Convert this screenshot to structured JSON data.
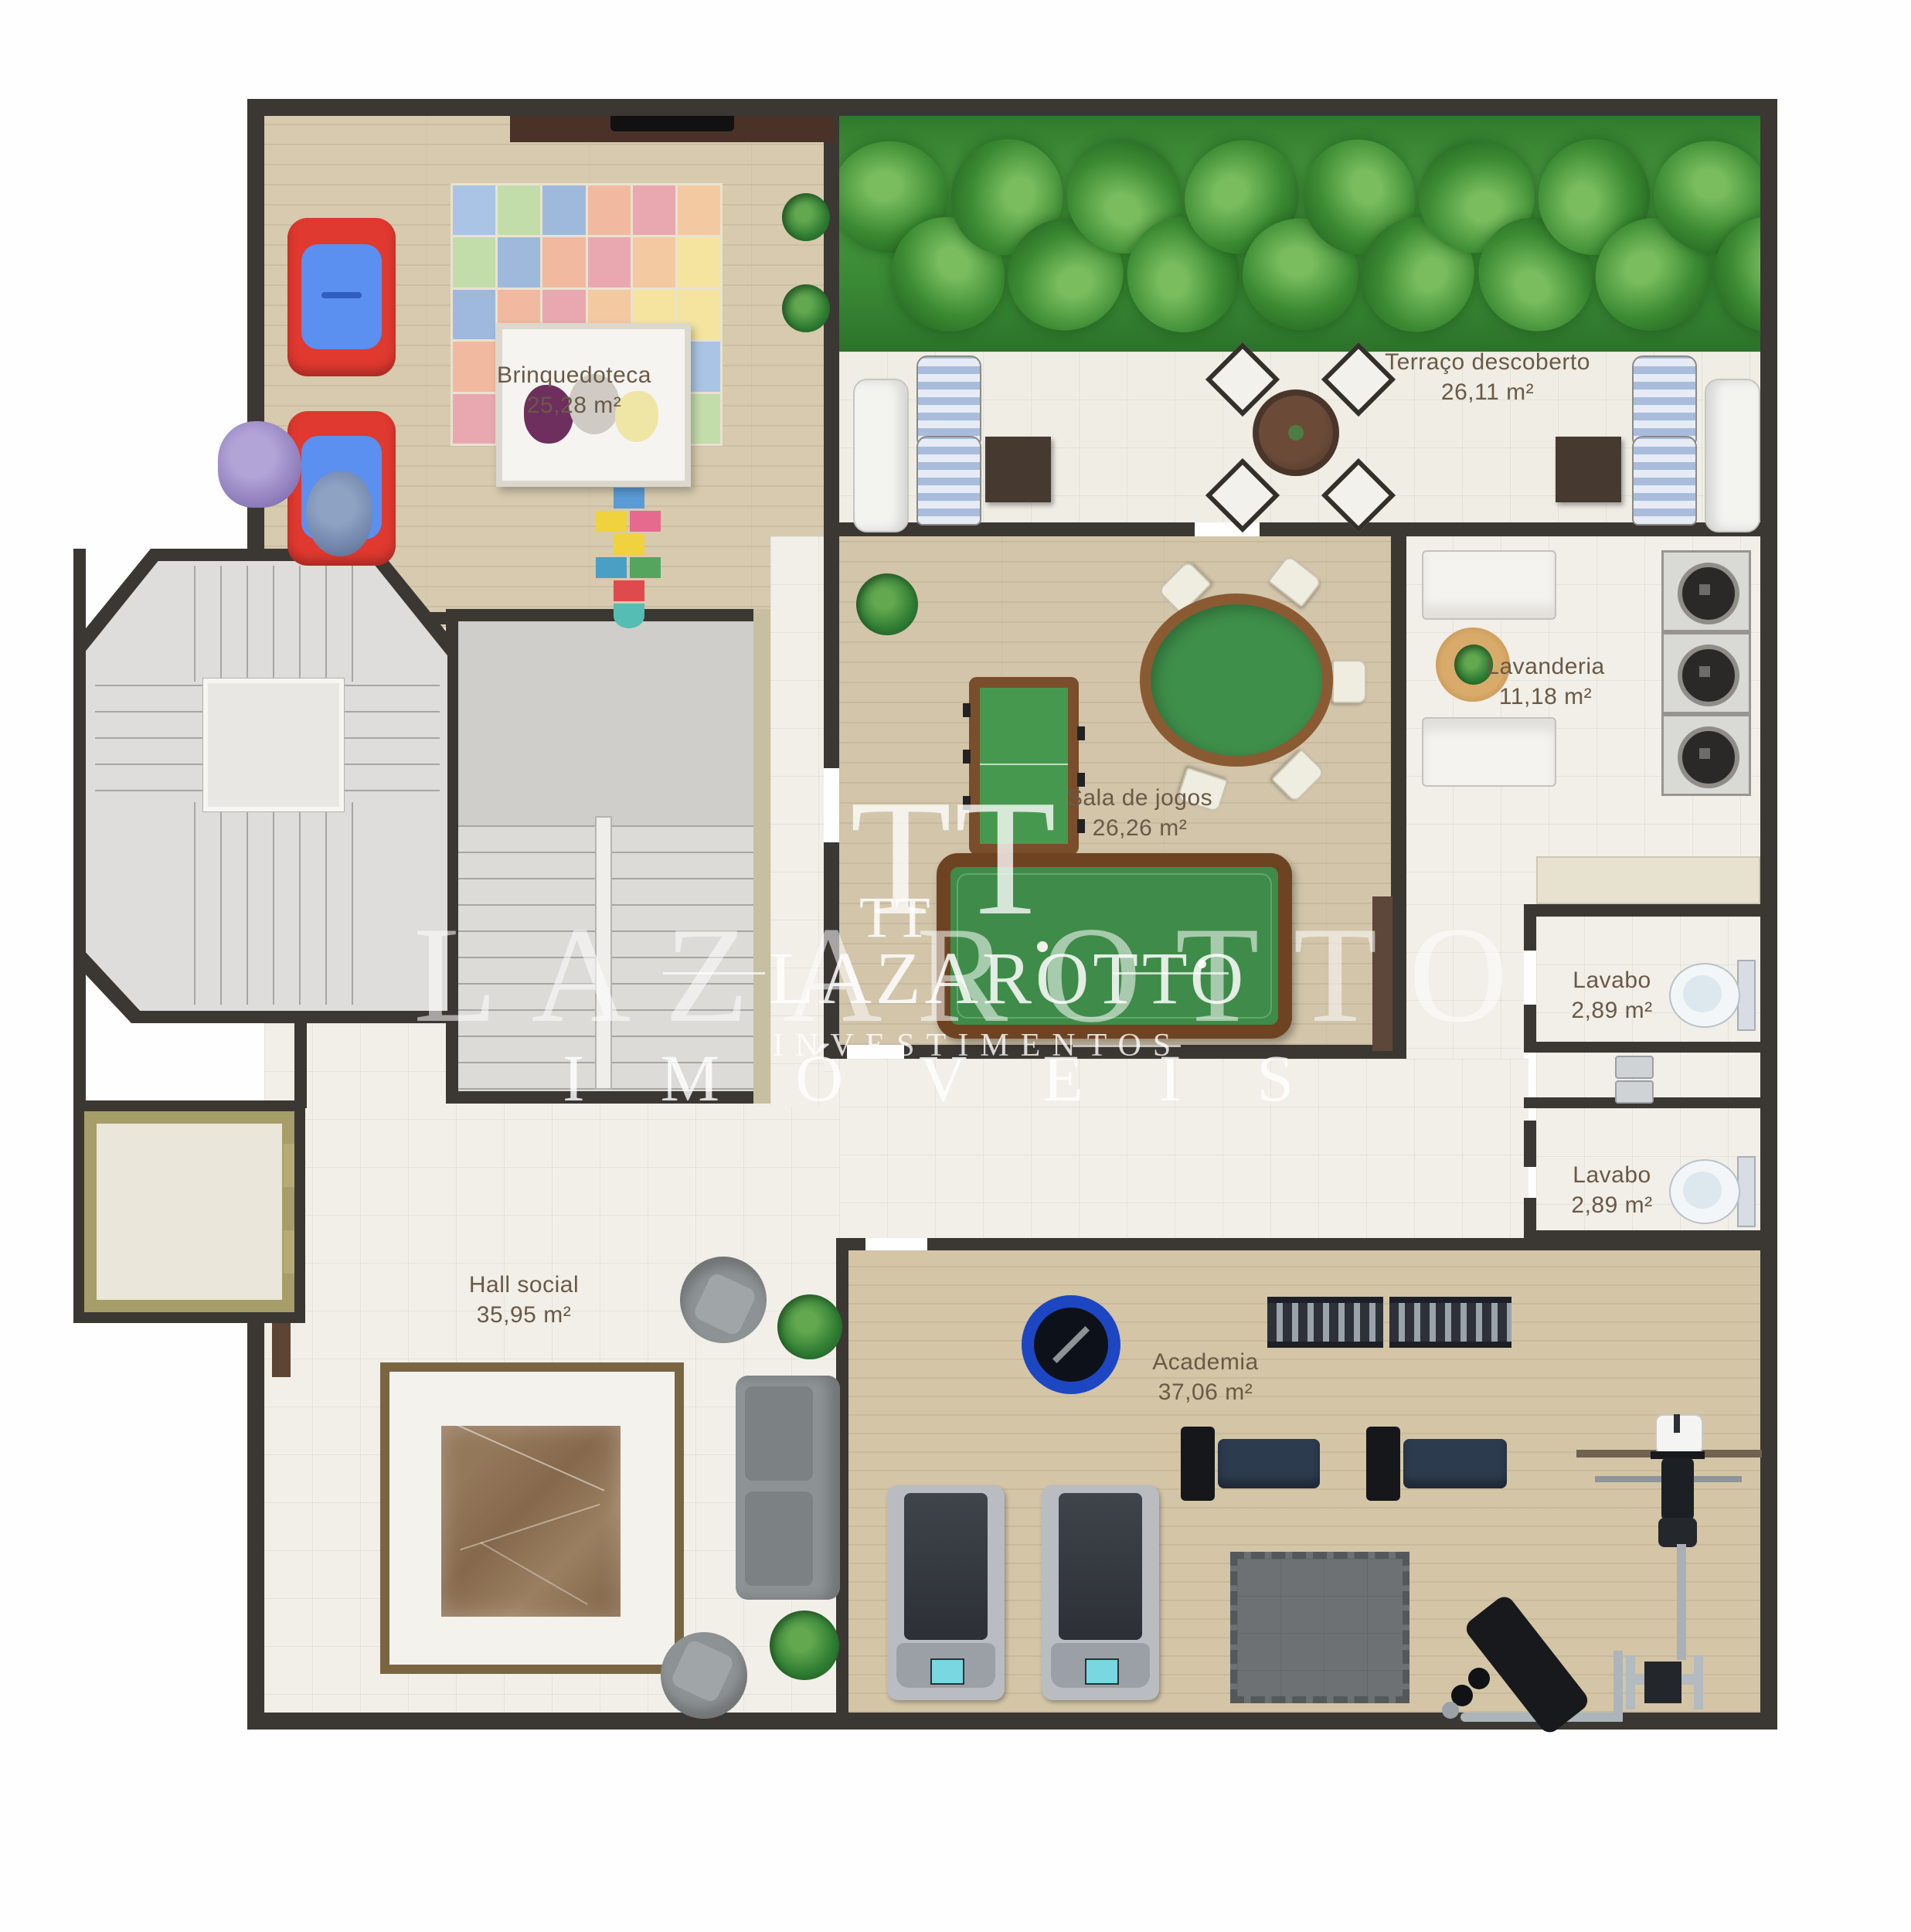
{
  "rooms": [
    {
      "name": "Brinquedoteca",
      "area": "25,28 m²"
    },
    {
      "name": "Terraço descoberto",
      "area": "26,11 m²"
    },
    {
      "name": "Sala de jogos",
      "area": "26,26 m²"
    },
    {
      "name": "Lavanderia",
      "area": "11,18 m²"
    },
    {
      "name": "Lavabo",
      "area": "2,89 m²"
    },
    {
      "name": "Lavabo",
      "area": "2,89 m²"
    },
    {
      "name": "Hall social",
      "area": "35,95 m²"
    },
    {
      "name": "Academia",
      "area": "37,06 m²"
    }
  ],
  "watermark": {
    "monogram": "TT",
    "brand": "LAZAROTTO",
    "division": "INVESTIMENTOS",
    "tagline": "IMÓVEIS",
    "small_monogram": "TT",
    "small_brand": "LAZAROTTO"
  },
  "colors": {
    "wall": "#3b3733",
    "wood_floor": "#d7caae",
    "tile_floor": "#f1efe8",
    "hedge_green": "#3f8f38",
    "felt_green": "#44904e",
    "table_brown": "#6e4326",
    "accent_red": "#e0392f",
    "accent_blue": "#5b8ff0",
    "label_text": "#6a5947",
    "watermark": "#ffffff"
  }
}
